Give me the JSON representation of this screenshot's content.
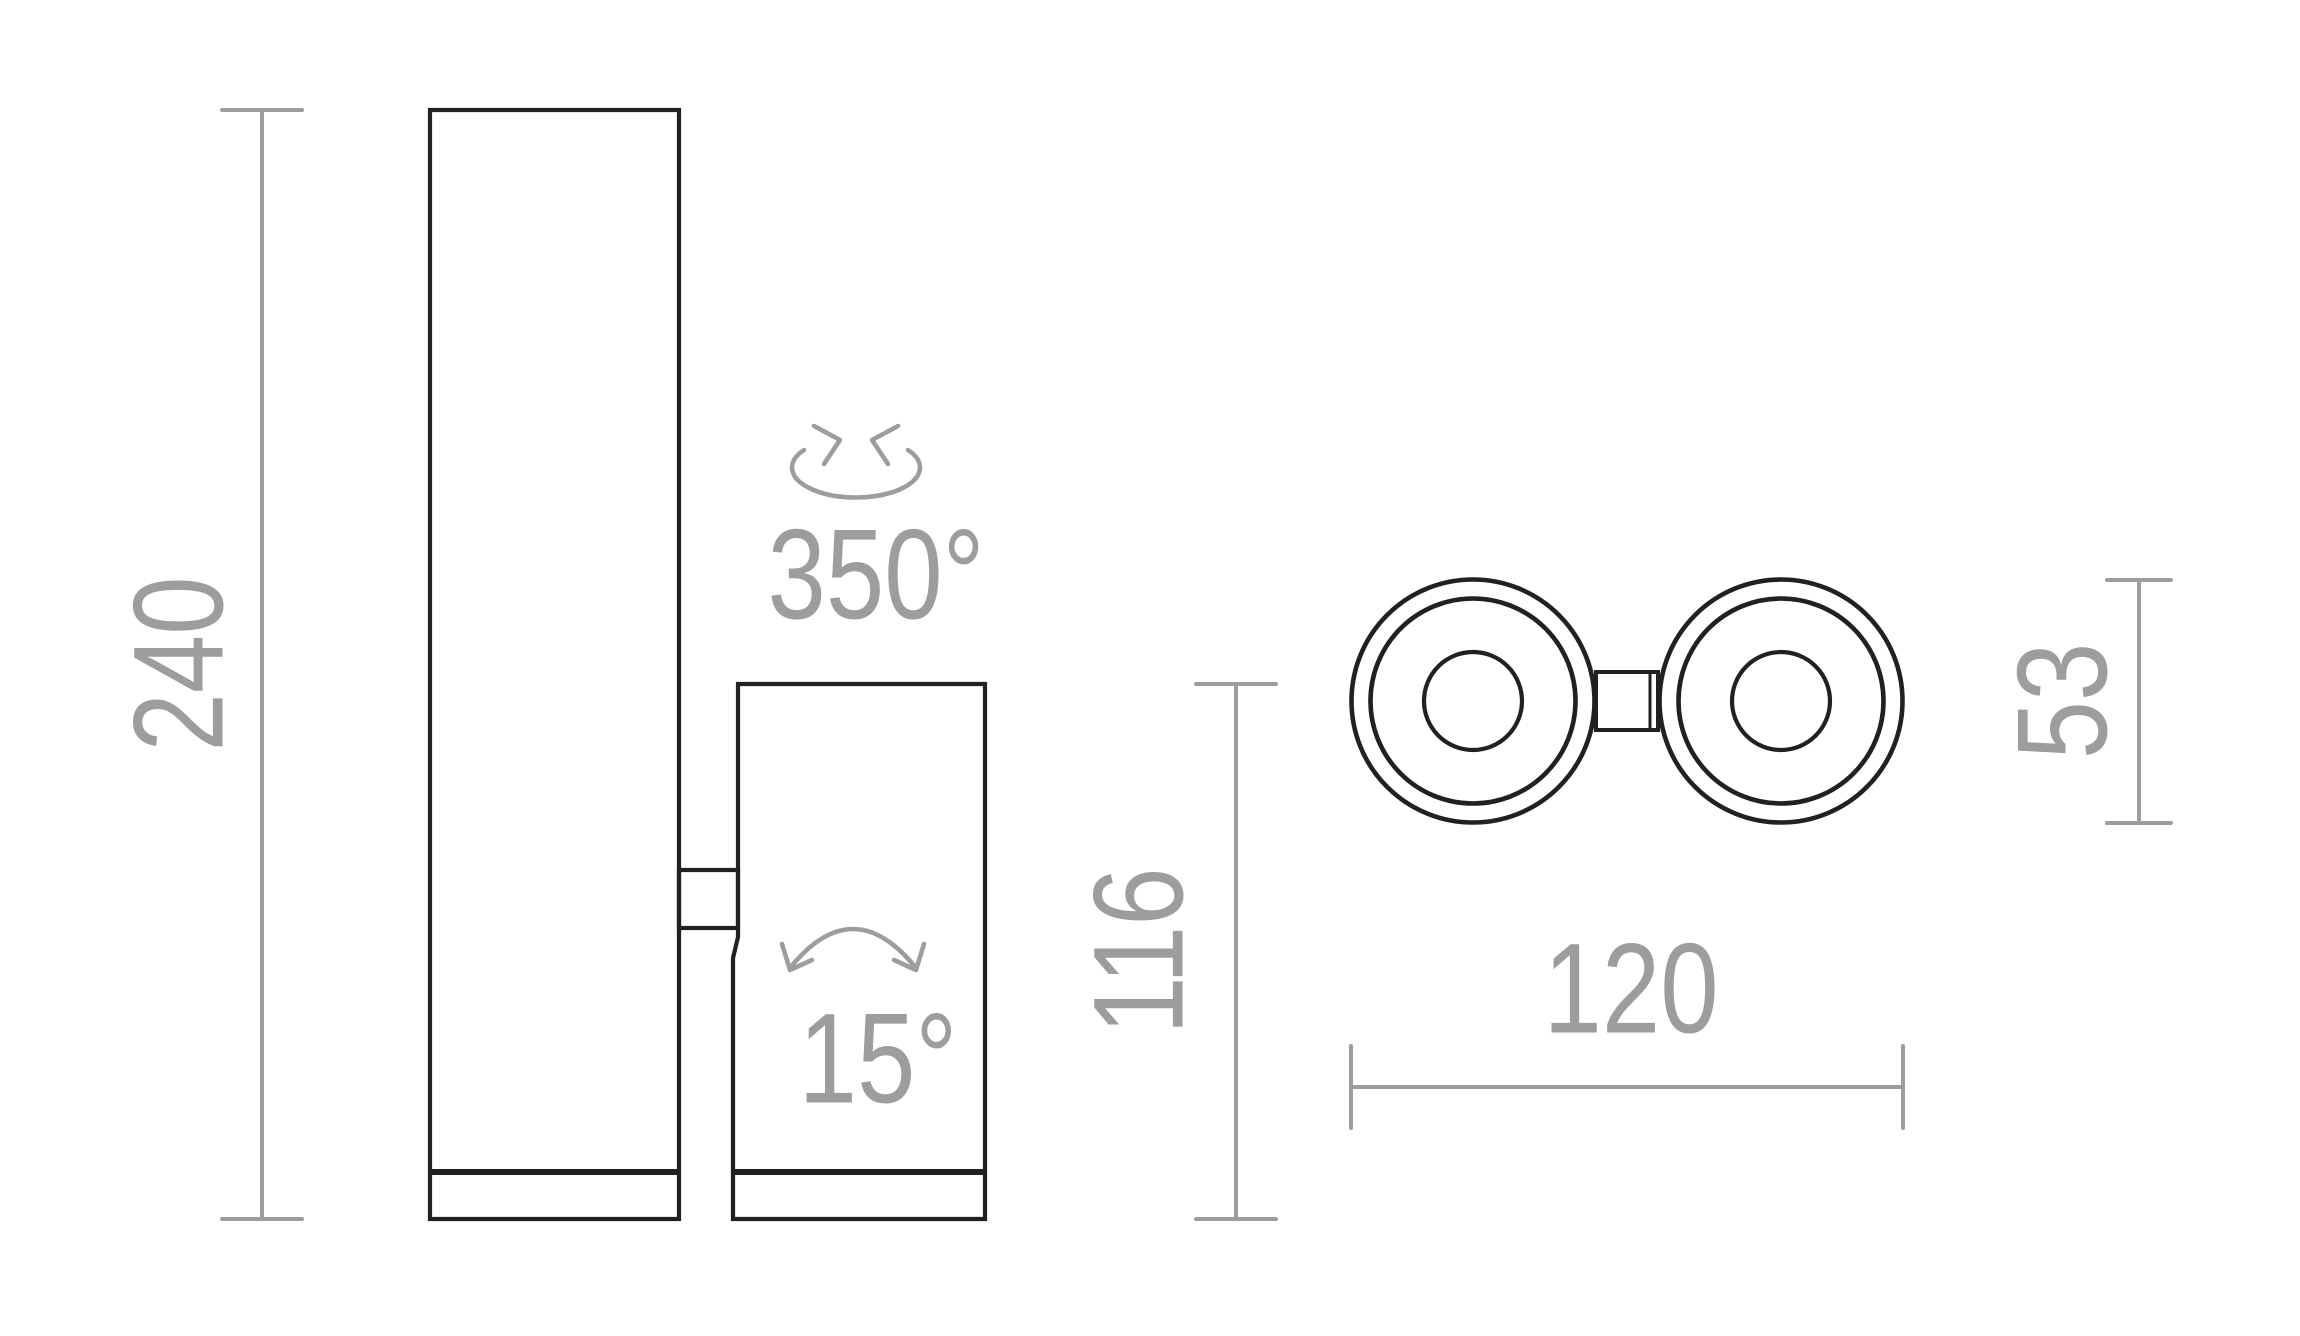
{
  "drawing": {
    "background": "#ffffff",
    "outline_color": "#232020",
    "dimension_color": "#9d9d9d"
  },
  "side_view": {
    "overall_height_mm": "240",
    "head_height_mm": "116",
    "swivel_angle": "350°",
    "tilt_angle": "15°"
  },
  "top_view": {
    "head_diameter_mm": "53",
    "overall_width_mm": "120"
  }
}
